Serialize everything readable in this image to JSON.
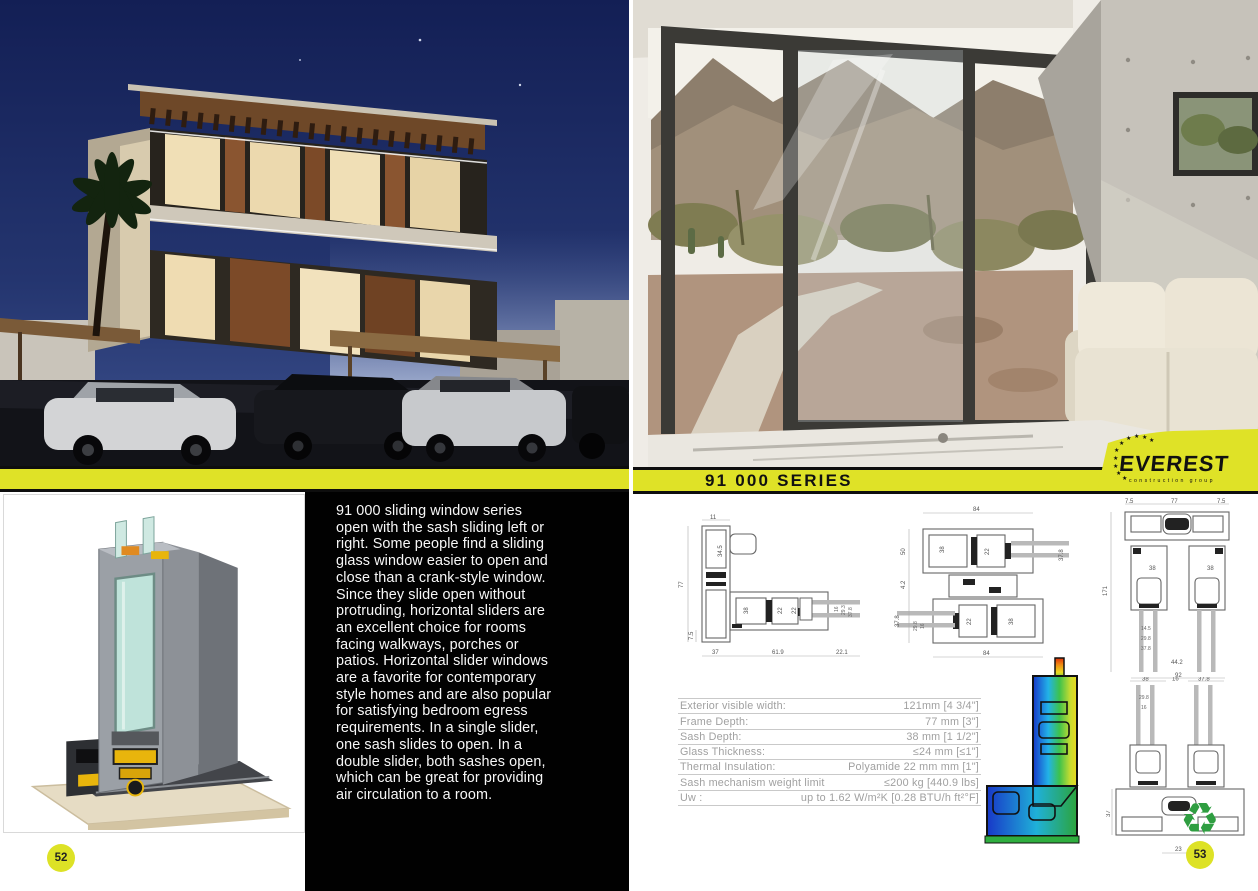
{
  "left_page": {
    "page_number": "52",
    "description_lines": [
      "91 000 sliding window series",
      "open with the sash sliding left or",
      "right. Some people find a sliding",
      "glass window easier to open and",
      "close than a crank-style window.",
      "Since they slide open without",
      "protruding, horizontal sliders are",
      "an excellent choice for rooms",
      "facing walkways, porches or",
      "patios. Horizontal slider windows",
      "are a favorite for contemporary",
      "style homes and are also popular",
      "for satisfying bedroom egress",
      "requirements. In a single slider,",
      "one sash slides to open. In a",
      "double slider, both sashes open,",
      "which can be great for providing",
      "air circulation to a room."
    ]
  },
  "right_page": {
    "page_number": "53",
    "banner_title": "91 000 SERIES",
    "logo": {
      "brand": "EVEREST",
      "tagline": "construction group"
    },
    "recycle_symbol": "♻",
    "specs": [
      {
        "label": "Exterior visible width:",
        "value": "121mm [4 3/4\"]"
      },
      {
        "label": "Frame Depth:",
        "value": "77 mm [3\"]"
      },
      {
        "label": "Sash Depth:",
        "value": "38 mm [1 1/2\"]"
      },
      {
        "label": "Glass Thickness:",
        "value": "≤24 mm [≤1\"]"
      },
      {
        "label": "Thermal Insulation:",
        "value": "Polyamide 22 mm mm [1\"]"
      },
      {
        "label": "Sash mechanism weight limit",
        "value": "≤200 kg [440.9 lbs]"
      },
      {
        "label": "Uw :",
        "value": "up to  1.62 W/m²K [0.28 BTU/h ft²°F]"
      }
    ]
  },
  "drawings": {
    "d1": {
      "dims": {
        "top": "11",
        "side": "34.5",
        "left": "77",
        "left_b": "7.5",
        "b1": "37",
        "b2": "61.9",
        "b3": "22.1",
        "m1": "38",
        "m2": "22",
        "m3": "22",
        "r1": "16",
        "r2": "29.3",
        "r3": "37.8"
      }
    },
    "d2": {
      "dims": {
        "top": "84",
        "l1": "50",
        "l2": "4.2",
        "l3": "37.8",
        "l4": "29.8",
        "l5": "16",
        "m1": "38",
        "m2": "22",
        "m3": "22",
        "m4": "38",
        "r1": "37.8",
        "bottom": "84"
      }
    },
    "d3": {
      "dims": {
        "t1": "7.5",
        "t2": "77",
        "t3": "7.5",
        "left": "171",
        "m1": "38",
        "m2": "38",
        "g1": "14.5",
        "g2": "29.8",
        "g3": "37.8",
        "b1": "44.2",
        "bottom": "92"
      }
    },
    "d4": {
      "dims": {
        "t1": "38",
        "t2": "16",
        "t3": "37.8",
        "g1": "29.8",
        "g2": "16",
        "left": "37",
        "bottom": "23"
      }
    }
  },
  "colors": {
    "accent_yellow": "#dfe227",
    "banner_text": "#111111",
    "panel_black": "#010101",
    "spec_text": "#a0a0a0",
    "recycle_green": "#2f9e41",
    "page_badge_yellow": "#dde226"
  }
}
